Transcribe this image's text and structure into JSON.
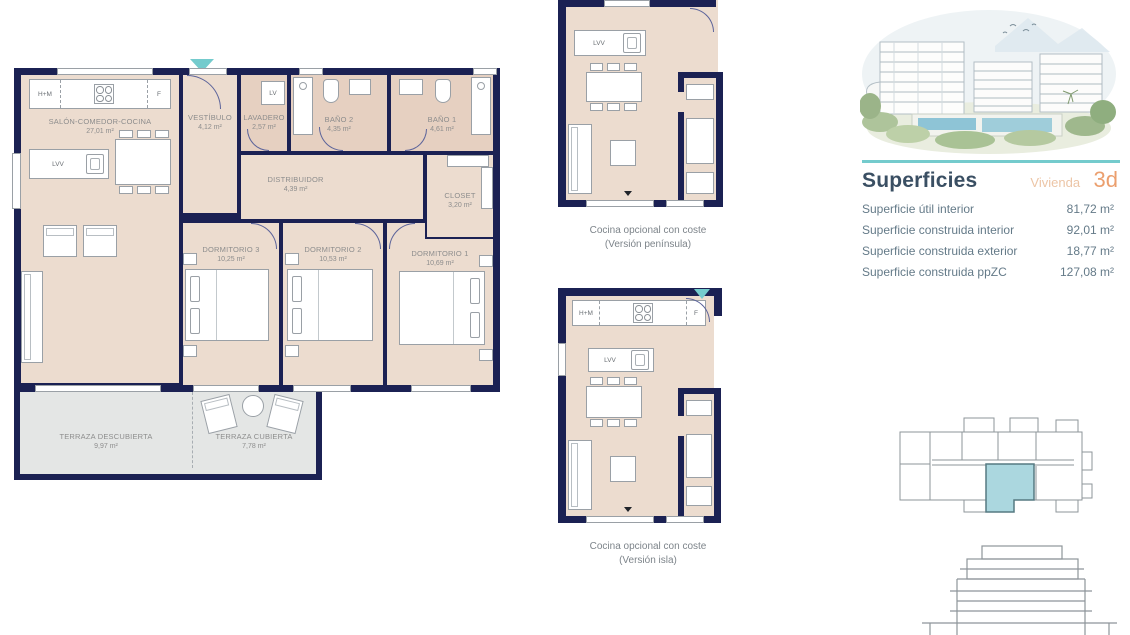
{
  "floorplan": {
    "appliances": {
      "hm": "H+M",
      "f": "F",
      "lv": "LV",
      "lvv": "LVV"
    },
    "rooms": {
      "salon": {
        "name": "SALÓN-COMEDOR-COCINA",
        "area": "27,01 m²"
      },
      "vestibulo": {
        "name": "VESTÍBULO",
        "area": "4,12 m²"
      },
      "lavadero": {
        "name": "LAVADERO",
        "area": "2,57 m²"
      },
      "bano2": {
        "name": "BAÑO 2",
        "area": "4,35 m²"
      },
      "bano1": {
        "name": "BAÑO 1",
        "area": "4,61 m²"
      },
      "distribuidor": {
        "name": "DISTRIBUIDOR",
        "area": "4,39 m²"
      },
      "closet": {
        "name": "CLOSET",
        "area": "3,20 m²"
      },
      "dorm3": {
        "name": "DORMITORIO 3",
        "area": "10,25 m²"
      },
      "dorm2": {
        "name": "DORMITORIO 2",
        "area": "10,53 m²"
      },
      "dorm1": {
        "name": "DORMITORIO 1",
        "area": "10,69 m²"
      },
      "terraza_descubierta": {
        "name": "TERRAZA DESCUBIERTA",
        "area": "9,97 m²"
      },
      "terraza_cubierta": {
        "name": "TERRAZA CUBIERTA",
        "area": "7,78 m²"
      }
    }
  },
  "kitchen_options": [
    {
      "line1": "Cocina opcional con coste",
      "line2": "(Versión península)"
    },
    {
      "line1": "Cocina opcional con coste",
      "line2": "(Versión isla)"
    }
  ],
  "superficies": {
    "title": "Superficies",
    "vivienda_label": "Vivienda",
    "vivienda_value": "3d",
    "rows": [
      {
        "label": "Superficie útil interior",
        "value": "81,72 m²"
      },
      {
        "label": "Superficie construida interior",
        "value": "92,01 m²"
      },
      {
        "label": "Superficie construida exterior",
        "value": "18,77 m²"
      },
      {
        "label": "Superficie construida ppZC",
        "value": "127,08 m²"
      }
    ]
  },
  "colors": {
    "wall_navy": "#1b2153",
    "floor_beige": "#ecdccf",
    "floor_tan": "#e6d0c1",
    "terrace_gray": "#e4e6e5",
    "teal_accent": "#74cbcd",
    "orange_accent": "#eb9f6e",
    "salmon_light": "#ecc5a6",
    "title_navy": "#3a4f63",
    "text_gray": "#647a88",
    "label_gray": "#8d8d8d",
    "unit_highlight": "#abd7df"
  }
}
